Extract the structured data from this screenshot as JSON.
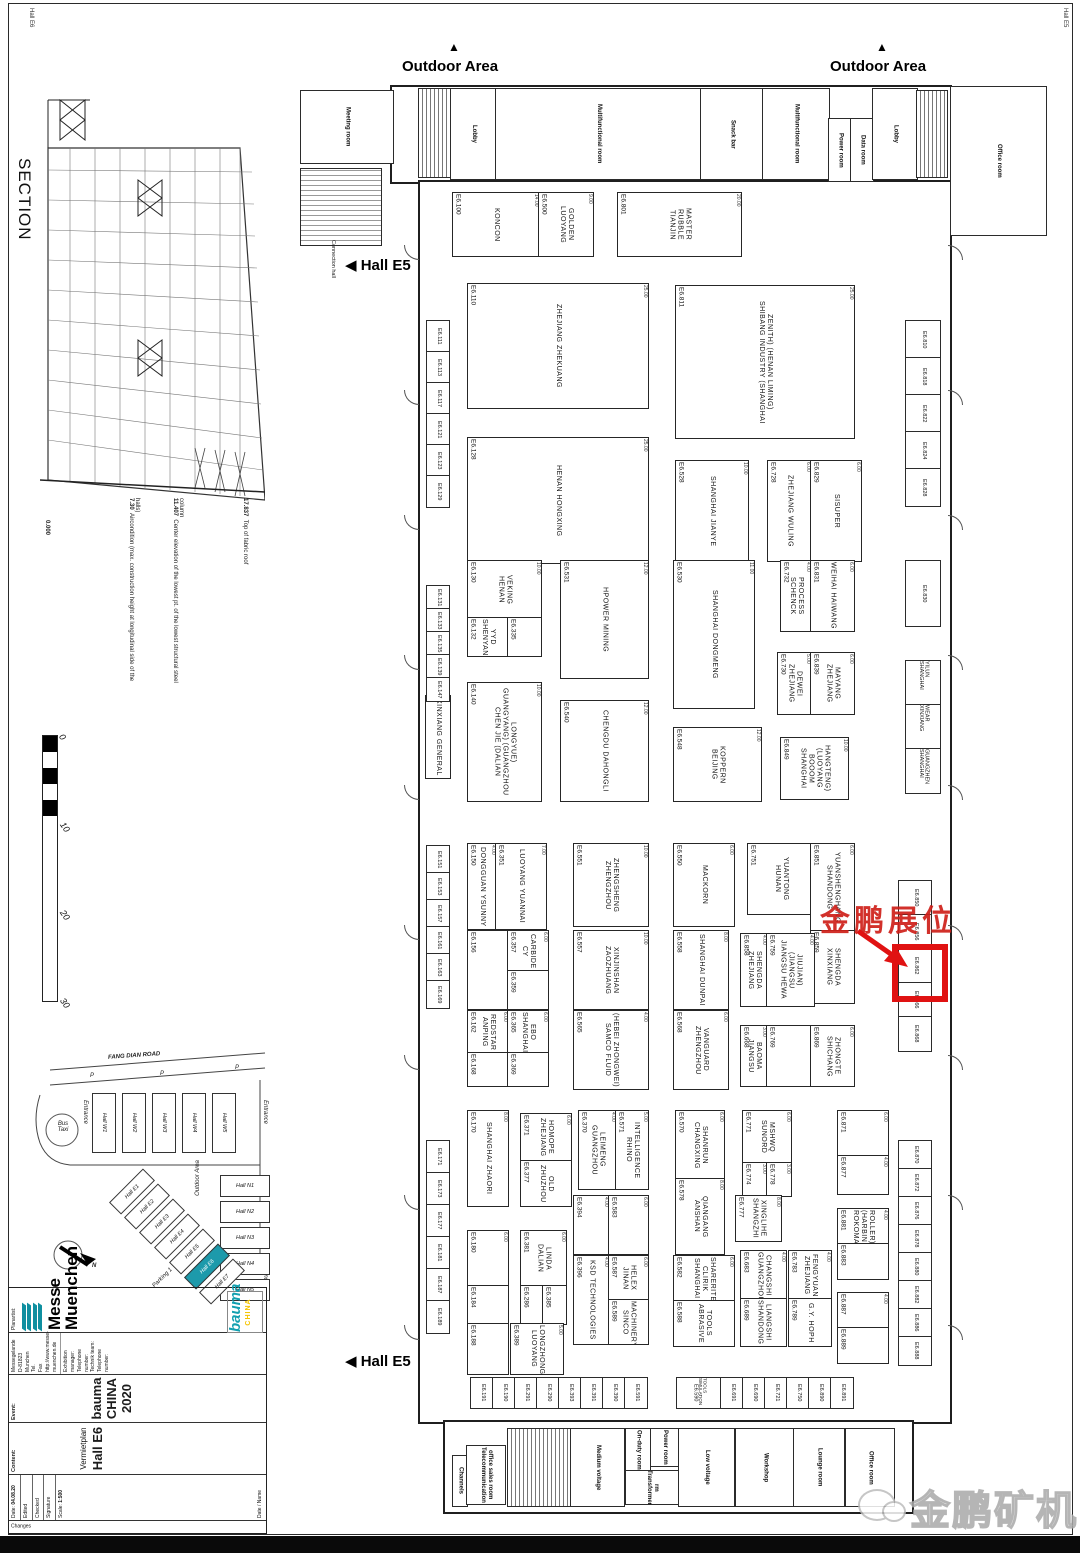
{
  "page": {
    "margin_top_left": "Hall E6",
    "margin_top_right": "Hall E5"
  },
  "annotations": {
    "outdoor_area": "Outdoor Area",
    "up_arrow_glyph": "▲",
    "hall_e5": "◀ Hall E5",
    "connection_hall": "Connection hall",
    "highlight_text": "金鹏展位",
    "watermark_text": "金鹏矿机"
  },
  "section": {
    "title": "SECTION",
    "elevations": [
      {
        "value": "17.837",
        "label": "Top of fabric roof"
      },
      {
        "value": "11.407",
        "label": "Center elevation of the lowest pt. of the lowest structural steel column"
      },
      {
        "value": "7.30",
        "label": "Aircondition (max. construction height at longitudinal side of the halls)"
      },
      {
        "value": "0.000",
        "label": ""
      }
    ]
  },
  "scalebar": {
    "ticks": [
      "0",
      "10",
      "20",
      "30"
    ]
  },
  "sitemap": {
    "road": "FANG DIAN ROAD",
    "parking": "P",
    "bus": "Bus Taxi",
    "entrance": "Entrance",
    "outdoor": "Outdoor Area",
    "parking1": "Parking 1",
    "north": "N",
    "halls_w": [
      "Hall W1",
      "Hall W2",
      "Hall W3",
      "Hall W4",
      "Hall W5"
    ],
    "halls_n": [
      "Hall N1",
      "Hall N2",
      "Hall N3",
      "Hall N4",
      "Hall N5"
    ],
    "halls_e": [
      "Hall E1",
      "Hall E2",
      "Hall E3",
      "Hall E4",
      "Hall E5",
      "Hall E6",
      "Hall E7"
    ],
    "highlighted_hall": "Hall E6"
  },
  "titleblock": {
    "planartist_label": "Planartist:",
    "company": "Messe Muenchen",
    "address_lines": [
      "Messegelande",
      "D-81823 Munchen",
      "Tel.",
      "Fax",
      "http://www.messe-muenchen.de"
    ],
    "contact_lines": [
      "Exhibition manager:",
      "Telephone number:",
      "Technik team:",
      "Telephone number:"
    ],
    "event_label": "Event:",
    "event": "bauma CHINA 2020",
    "content_label": "Content:",
    "content1": "Vermietplan",
    "content2": "Hall E6",
    "date_label": "Date:",
    "date": "04.08.20",
    "fields": [
      "Edited",
      "Checked",
      "Signature",
      "Scale:"
    ],
    "scale": "1:500",
    "changes_label": "Changes",
    "grid_headers": [
      "Date",
      "Name"
    ],
    "bauma": "bauma",
    "bauma_sub": "CHINA"
  },
  "plan": {
    "rooms": [
      [
        300,
        90,
        92,
        72,
        "Meeting room",
        ""
      ],
      [
        300,
        168,
        80,
        76,
        "",
        "hatch"
      ],
      [
        418,
        88,
        32,
        88,
        "",
        "stairs"
      ],
      [
        450,
        88,
        45,
        90,
        "Lobby",
        ""
      ],
      [
        495,
        88,
        205,
        90,
        "Multifunctional room",
        ""
      ],
      [
        700,
        88,
        62,
        90,
        "Snack bar",
        ""
      ],
      [
        762,
        88,
        66,
        90,
        "Multifunctional room",
        ""
      ],
      [
        828,
        118,
        22,
        62,
        "Power room",
        ""
      ],
      [
        850,
        118,
        22,
        62,
        "Data room",
        ""
      ],
      [
        872,
        88,
        44,
        90,
        "Lobby",
        ""
      ],
      [
        916,
        90,
        30,
        86,
        "",
        "stairs"
      ],
      [
        950,
        86,
        95,
        148,
        "Office room",
        ""
      ],
      [
        452,
        1455,
        14,
        50,
        "Channels",
        ""
      ],
      [
        466,
        1445,
        38,
        58,
        "Telecommunication office sales room",
        ""
      ],
      [
        507,
        1428,
        62,
        77,
        "",
        "stairs"
      ],
      [
        570,
        1428,
        53,
        77,
        "Medium voltage",
        ""
      ],
      [
        625,
        1428,
        24,
        42,
        "On-duty room",
        ""
      ],
      [
        650,
        1428,
        27,
        37,
        "Power room",
        ""
      ],
      [
        625,
        1470,
        52,
        33,
        "Transformer rm",
        ""
      ],
      [
        678,
        1428,
        55,
        77,
        "Low voltage",
        ""
      ],
      [
        735,
        1428,
        58,
        77,
        "Workshop",
        ""
      ],
      [
        793,
        1428,
        50,
        77,
        "Lounge room",
        ""
      ],
      [
        845,
        1428,
        48,
        77,
        "Office room",
        ""
      ]
    ],
    "booths": [
      [
        452,
        192,
        86,
        63,
        "E6.100",
        "KONCON",
        "14.00"
      ],
      [
        538,
        192,
        54,
        63,
        "E6.500",
        "LUOYANG GOLDEN",
        "9.00"
      ],
      [
        617,
        192,
        123,
        63,
        "E6.801",
        "TIANJIN RUBBLE MASTER",
        "20.00"
      ],
      [
        467,
        283,
        180,
        124,
        "E6.110",
        "ZHEJIANG ZHEKUANG",
        "25.00"
      ],
      [
        675,
        285,
        178,
        152,
        "E6.811",
        "SHIBANG INDUSTRY (SHANGHAI ZENITH) (HENAN LIMING)",
        "25.00"
      ],
      [
        467,
        437,
        180,
        125,
        "E6.128",
        "HENAN HONGXING",
        "25.00"
      ],
      [
        675,
        460,
        72,
        100,
        "E6.528",
        "SHANGHAI JIANYE",
        "10.00"
      ],
      [
        767,
        460,
        43,
        100,
        "E6.728",
        "ZHEJIANG WULING",
        "6.00"
      ],
      [
        810,
        460,
        50,
        100,
        "E6.829",
        "SISUPER",
        "6.00"
      ],
      [
        467,
        560,
        73,
        57,
        "E6.130",
        "HENAN VEKING",
        "10.00"
      ],
      [
        467,
        617,
        40,
        38,
        "E6.132",
        "SHENYANG YYD",
        ""
      ],
      [
        507,
        617,
        33,
        38,
        "E6.335",
        "",
        ""
      ],
      [
        560,
        560,
        87,
        117,
        "E6.531",
        "HPOWER MINING",
        "12.00"
      ],
      [
        673,
        560,
        80,
        147,
        "E6.530",
        "SHANGHAI DONGMENG",
        "11.00"
      ],
      [
        780,
        560,
        30,
        70,
        "E6.732",
        "SCHENCK PROCESS",
        "4.00"
      ],
      [
        810,
        560,
        43,
        70,
        "E6.831",
        "WEIHAI HAIWANG",
        "6.00"
      ],
      [
        777,
        652,
        33,
        61,
        "E6.730",
        "ZHEJIANG DEWEI",
        "5.00"
      ],
      [
        810,
        652,
        43,
        61,
        "E6.839",
        "ZHEJIANG MAYANG",
        "6.00"
      ],
      [
        467,
        682,
        73,
        118,
        "E6.140",
        "CHEN JIE (DALIAN GUANGYANG) (GUANGZHOU LONGYUE)",
        "10.00"
      ],
      [
        560,
        700,
        87,
        100,
        "E6.540",
        "CHENGDU DAHONGLI",
        "12.00"
      ],
      [
        673,
        727,
        87,
        73,
        "E6.548",
        "BEIJING KOPPERN",
        "12.00"
      ],
      [
        780,
        737,
        67,
        61,
        "E6.849",
        "SHANGHAI BOOOM (LUOYANG HANGTENG)",
        "10.00"
      ],
      [
        425,
        695,
        24,
        82,
        "",
        "XINXIANG GENERAL",
        ""
      ],
      [
        467,
        843,
        28,
        85,
        "E6.150",
        "DONGGUAN YSUNNY",
        "4.00"
      ],
      [
        495,
        843,
        50,
        85,
        "E6.351",
        "LUOYANG YUANNAI",
        "7.00"
      ],
      [
        573,
        843,
        74,
        82,
        "E6.551",
        "ZHENGZHOU ZHENGSHENG",
        "10.00"
      ],
      [
        673,
        843,
        60,
        82,
        "E6.550",
        "MACKORN",
        "6.00"
      ],
      [
        747,
        843,
        66,
        70,
        "E6.751",
        "HUNAN YUANTONG",
        "6.00"
      ],
      [
        810,
        843,
        43,
        87,
        "E6.851",
        "SHANDONG YUANSHENGHANG",
        "6.00"
      ],
      [
        810,
        930,
        43,
        72,
        "E6.859",
        "XINXIANG SHENGDA",
        ""
      ],
      [
        467,
        930,
        40,
        78,
        "E6.156",
        "",
        ""
      ],
      [
        507,
        930,
        40,
        40,
        "E6.357",
        "CY CARBIDE",
        "6.00"
      ],
      [
        507,
        970,
        40,
        38,
        "E6.359",
        "",
        ""
      ],
      [
        573,
        930,
        74,
        78,
        "E6.557",
        "ZAOZHUANG XINJINSHAN",
        "10.00"
      ],
      [
        673,
        930,
        54,
        78,
        "E6.558",
        "SHANGHAI DUNPAI",
        "8.00"
      ],
      [
        740,
        933,
        26,
        72,
        "E6.858",
        "ZHEJIANG SHENGDA",
        "4.00"
      ],
      [
        766,
        933,
        47,
        72,
        "E6.759",
        "JIANGSU HEWA (JIANGSU JIUJIAN)",
        "4.00"
      ],
      [
        467,
        1010,
        40,
        42,
        "E6.162",
        "ANPING REDSTAR",
        "6.00"
      ],
      [
        467,
        1052,
        40,
        33,
        "E6.168",
        "",
        ""
      ],
      [
        507,
        1010,
        40,
        42,
        "E6.365",
        "SHANGHAI EBO",
        "6.00"
      ],
      [
        507,
        1052,
        40,
        33,
        "E6.369",
        "",
        ""
      ],
      [
        573,
        1010,
        74,
        78,
        "E6.565",
        "SAMCO FLUID (HEBEI ZHONGWEI)",
        "4.00"
      ],
      [
        673,
        1010,
        54,
        78,
        "E6.568",
        "ZHENGZHOU VANGUARD",
        "6.00"
      ],
      [
        740,
        1025,
        26,
        60,
        "E6.668",
        "JIANGSU BAOMA",
        "3.00"
      ],
      [
        766,
        1025,
        47,
        60,
        "E6.769",
        "",
        "6.00"
      ],
      [
        810,
        1025,
        43,
        60,
        "E6.869",
        "SHICHANG ZHONGTE",
        "6.00"
      ],
      [
        467,
        1110,
        40,
        95,
        "E6.170",
        "SHANGHAI ZHAORI",
        "8.00"
      ],
      [
        520,
        1113,
        50,
        47,
        "E6.371",
        "ZHEJIANG HOMOPE",
        "6.00"
      ],
      [
        520,
        1160,
        50,
        45,
        "E6.377",
        "ZHUZHOU OLD",
        ""
      ],
      [
        578,
        1110,
        37,
        78,
        "E6.370",
        "GUANGZHOU LEIMENG",
        "4.00"
      ],
      [
        615,
        1110,
        32,
        78,
        "E6.571",
        "RHINO INTELLIGENCE",
        "5.00"
      ],
      [
        675,
        1110,
        48,
        68,
        "E6.570",
        "CHANGXING SHANRUN",
        "6.00"
      ],
      [
        675,
        1178,
        48,
        75,
        "E6.578",
        "ANSHAN QIANGANG",
        "8.00"
      ],
      [
        742,
        1110,
        48,
        52,
        "E6.771",
        "SUNORD MSHWQ",
        "6.00"
      ],
      [
        742,
        1162,
        24,
        33,
        "E6.774",
        "",
        "3.00"
      ],
      [
        766,
        1162,
        24,
        33,
        "E6.778",
        "",
        "3.00"
      ],
      [
        837,
        1110,
        50,
        45,
        "E6.871",
        "",
        "6.00"
      ],
      [
        837,
        1155,
        50,
        38,
        "E6.877",
        "",
        "4.00"
      ],
      [
        735,
        1195,
        45,
        45,
        "E6.777",
        "SHANGZHI XINGLIHE",
        "8.00"
      ],
      [
        837,
        1208,
        50,
        35,
        "E6.881",
        "ROKOMA (HARBIN ROLLER)",
        "4.00"
      ],
      [
        837,
        1243,
        50,
        35,
        "E6.883",
        "",
        ""
      ],
      [
        467,
        1230,
        40,
        55,
        "E6.180",
        "",
        "6.00"
      ],
      [
        467,
        1285,
        40,
        38,
        "E6.184",
        "",
        ""
      ],
      [
        520,
        1230,
        45,
        55,
        "E6.381",
        "DALIAN LINDA",
        "6.00"
      ],
      [
        520,
        1285,
        22,
        38,
        "E6.286",
        "",
        ""
      ],
      [
        542,
        1285,
        23,
        38,
        "E6.385",
        "",
        ""
      ],
      [
        573,
        1195,
        35,
        58,
        "E6.394",
        "",
        "4.00"
      ],
      [
        608,
        1195,
        39,
        58,
        "E6.583",
        "",
        "6.00"
      ],
      [
        573,
        1255,
        35,
        88,
        "E6.396",
        "KSD TECHNOLOGIES",
        "4.00"
      ],
      [
        608,
        1255,
        39,
        44,
        "E6.587",
        "JINAN HELEX",
        "6.00"
      ],
      [
        608,
        1299,
        39,
        44,
        "E6.589",
        "SINCO MACHINERY",
        ""
      ],
      [
        673,
        1255,
        60,
        45,
        "E6.582",
        "SHANGHAI CLIRIK SHARERITE",
        "6.00"
      ],
      [
        673,
        1300,
        60,
        45,
        "E6.588",
        "ABRASIVE TOOLS",
        ""
      ],
      [
        740,
        1250,
        45,
        48,
        "E6.683",
        "GUANGZHOU CHANGSHI",
        "4.00"
      ],
      [
        740,
        1298,
        45,
        47,
        "E6.689",
        "SHANDONG LIANGSHI",
        ""
      ],
      [
        788,
        1250,
        42,
        48,
        "E6.783",
        "ZHEJIANG FENGYUAN",
        "4.00"
      ],
      [
        788,
        1298,
        42,
        47,
        "E6.789",
        "G.Y. HOPH",
        ""
      ],
      [
        837,
        1292,
        50,
        35,
        "E6.887",
        "",
        "4.00"
      ],
      [
        837,
        1327,
        50,
        35,
        "E6.889",
        "",
        ""
      ],
      [
        467,
        1323,
        40,
        50,
        "E6.188",
        "",
        ""
      ],
      [
        510,
        1323,
        52,
        50,
        "E6.389",
        "LUOYANG LONGZHONG",
        "5.00"
      ]
    ],
    "strips": [
      {
        "x": 426,
        "y": 320,
        "w": 22,
        "ch": 31,
        "items": [
          "E6.111",
          "E6.113",
          "E6.117",
          "E6.121",
          "E6.123",
          "E6.129"
        ]
      },
      {
        "x": 426,
        "y": 585,
        "w": 22,
        "ch": 23,
        "items": [
          "E6.131",
          "E6.133",
          "E6.135",
          "E6.139",
          "E6.147"
        ]
      },
      {
        "x": 426,
        "y": 845,
        "w": 22,
        "ch": 27,
        "items": [
          "E6.151",
          "E6.153",
          "E6.157",
          "E6.161",
          "E6.163",
          "E6.169"
        ]
      },
      {
        "x": 426,
        "y": 1140,
        "w": 22,
        "ch": 32,
        "items": [
          "E6.171",
          "E6.173",
          "E6.177",
          "E6.181",
          "E6.187",
          "E6.189"
        ]
      },
      {
        "x": 905,
        "y": 320,
        "w": 34,
        "ch": 37,
        "items": [
          "E6.810",
          "E6.818",
          "E6.822",
          "E6.824",
          "E6.828"
        ]
      },
      {
        "x": 905,
        "y": 560,
        "w": 34,
        "ch": 65,
        "items": [
          "E6.830"
        ]
      },
      {
        "x": 905,
        "y": 660,
        "w": 34,
        "ch": 44,
        "items": [
          "SHANGHAI YILUN",
          "XINXIANG WEAR",
          "SHANGHAI GUANGZHEN"
        ]
      },
      {
        "x": 898,
        "y": 880,
        "w": 32,
        "ch": 34,
        "items": [
          "E6.850",
          "E6.856",
          "E6.862",
          "E6.866",
          "E6.868"
        ]
      },
      {
        "x": 898,
        "y": 1140,
        "w": 32,
        "ch": 28,
        "items": [
          "E6.870",
          "E6.872",
          "E6.876",
          "E6.878",
          "E6.880",
          "E6.882",
          "E6.886",
          "E6.888"
        ]
      }
    ],
    "rows": [
      {
        "x": 470,
        "y": 1377,
        "h": 30,
        "cells": [
          [
            22,
            "E6.191",
            ""
          ],
          [
            22,
            "E6.190",
            ""
          ],
          [
            22,
            "E6.291",
            ""
          ],
          [
            22,
            "E6.290",
            ""
          ],
          [
            22,
            "E6.393",
            ""
          ],
          [
            22,
            "E6.391",
            ""
          ],
          [
            22,
            "E6.390",
            ""
          ],
          [
            22,
            "E6.591",
            ""
          ]
        ]
      },
      {
        "x": 676,
        "y": 1377,
        "h": 30,
        "cells": [
          [
            44,
            "E6.590",
            "SIMULATION TOOLS"
          ],
          [
            22,
            "E6.691",
            ""
          ],
          [
            22,
            "E6.690",
            ""
          ],
          [
            22,
            "E6.721",
            ""
          ],
          [
            22,
            "E6.750",
            ""
          ],
          [
            22,
            "E6.890",
            ""
          ],
          [
            22,
            "E6.891",
            ""
          ]
        ]
      }
    ],
    "doors_y": [
      245,
      390,
      515,
      655,
      785,
      925,
      1055,
      1195,
      1325
    ]
  }
}
